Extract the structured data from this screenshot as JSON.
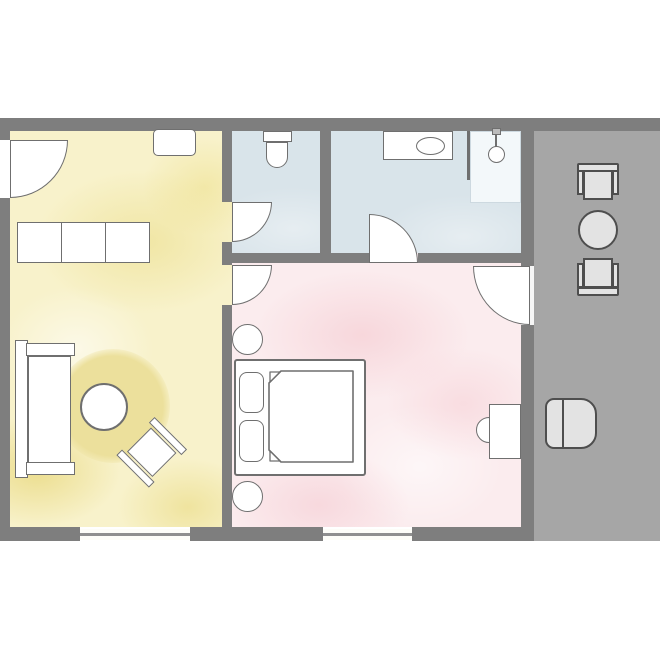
{
  "title": "apartment-floor-plan",
  "colors": {
    "background": "#ffffff",
    "wall": "#7e7e7e",
    "outdoor-area": "#a6a6a6",
    "room-living": "#f8f2cb",
    "room-bath": "#d9e4ea",
    "room-bedroom": "#fbecee",
    "shower-tray": "#f3f8fa",
    "rug": "#ece09c",
    "furniture-fill": "#ffffff",
    "furniture-stroke": "#6f6f6f",
    "outdoor-furniture-fill": "#e3e3e3",
    "outdoor-furniture-stroke": "#4e4e4e",
    "window-line": "#8f8f8f"
  },
  "rooms": [
    {
      "name": "living-room",
      "fill": "pale-yellow-watercolor",
      "fixtures": [
        "entrance-door",
        "wall-cabinet",
        "sideboard-3-sections",
        "sofa",
        "round-rug",
        "coffee-table",
        "side-chair-rotated",
        "window-south"
      ]
    },
    {
      "name": "wc",
      "fill": "pale-blue-watercolor",
      "fixtures": [
        "wc-door",
        "toilet"
      ]
    },
    {
      "name": "bathroom",
      "fill": "pale-blue-watercolor",
      "fixtures": [
        "bathroom-door",
        "sink-counter",
        "sink-basin",
        "glass-partition",
        "shower-tray",
        "shower-head"
      ]
    },
    {
      "name": "bedroom",
      "fill": "pale-pink-watercolor",
      "fixtures": [
        "door-from-living-room",
        "terrace-door",
        "double-bed",
        "pillow-left",
        "pillow-right",
        "duvet-folded-corners",
        "nightstand-round-north",
        "nightstand-round-south",
        "desk",
        "desk-chair",
        "window-south"
      ]
    },
    {
      "name": "terrace",
      "fill": "gray",
      "fixtures": [
        "terrace-chair-north",
        "terrace-round-table",
        "terrace-chair-south",
        "lounge-chair"
      ]
    }
  ],
  "doors": [
    {
      "name": "entrance-door",
      "swing": "quarter-arc"
    },
    {
      "name": "wc-door",
      "swing": "quarter-arc"
    },
    {
      "name": "bathroom-door",
      "swing": "quarter-arc"
    },
    {
      "name": "door-from-living-room",
      "swing": "quarter-arc"
    },
    {
      "name": "terrace-door",
      "swing": "quarter-arc"
    }
  ],
  "windows": [
    {
      "name": "window-living-room"
    },
    {
      "name": "window-bedroom"
    }
  ]
}
